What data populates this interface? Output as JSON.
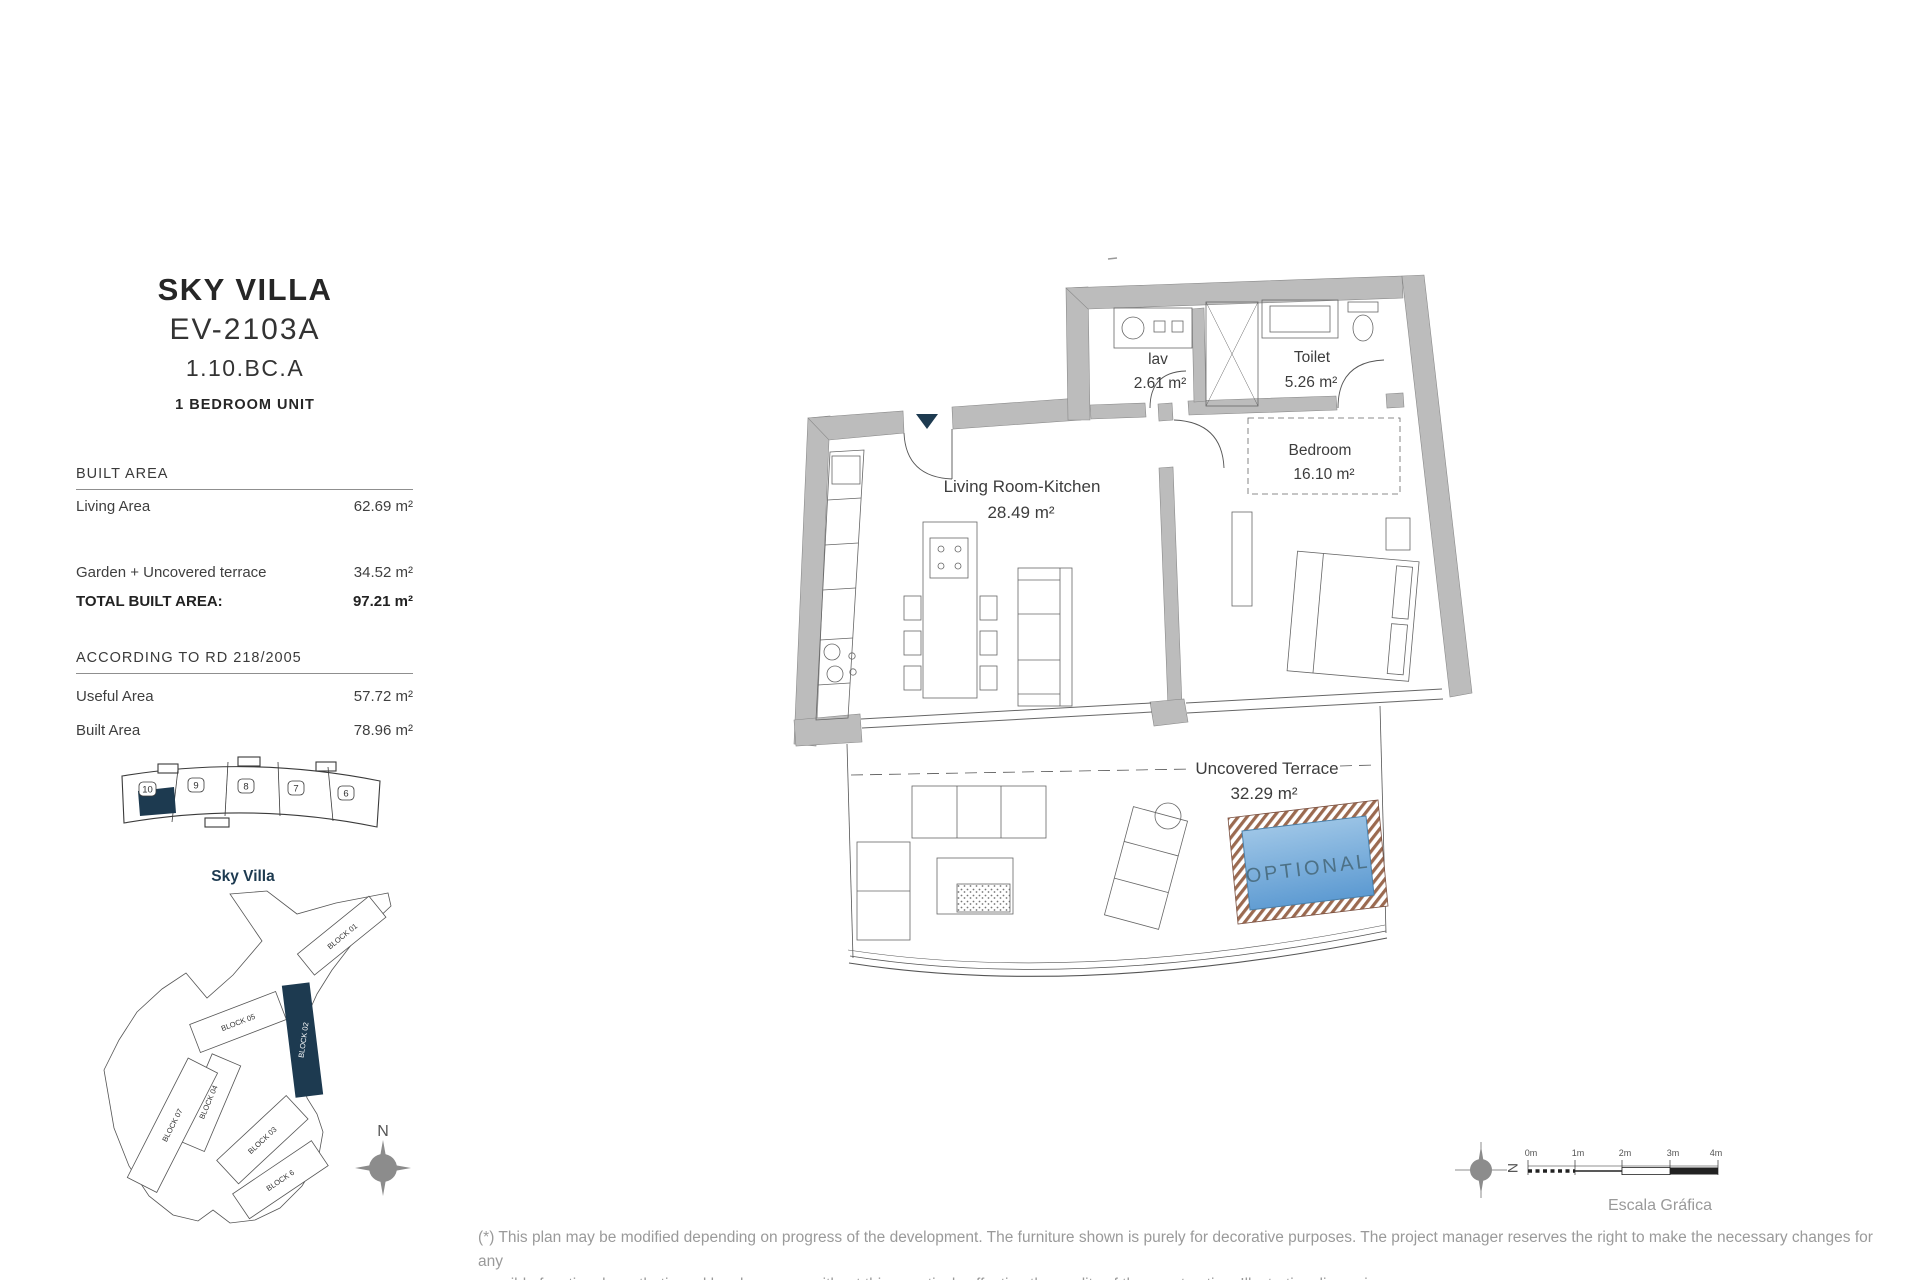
{
  "header": {
    "title": "SKY VILLA",
    "code": "EV-2103A",
    "ref": "1.10.BC.A",
    "unit_type": "1 BEDROOM UNIT"
  },
  "built_area": {
    "title": "BUILT AREA",
    "rows": [
      {
        "label": "Living Area",
        "value": "62.69 m²"
      },
      {
        "label": "Garden + Uncovered terrace",
        "value": "34.52 m²"
      },
      {
        "label": "TOTAL BUILT AREA:",
        "value": "97.21 m²"
      }
    ]
  },
  "rd_area": {
    "title": "ACCORDING TO RD 218/2005",
    "rows": [
      {
        "label": "Useful Area",
        "value": "57.72 m²"
      },
      {
        "label": "Built Area",
        "value": "78.96 m²"
      }
    ]
  },
  "floor_strip": {
    "units": [
      "10",
      "9",
      "8",
      "7",
      "6"
    ],
    "label": "Sky Villa"
  },
  "site_plan": {
    "blocks": [
      "BLOCK 01",
      "BLOCK 02",
      "BLOCK 05",
      "BLOCK 04",
      "BLOCK 07",
      "BLOCK 03",
      "BLOCK 6"
    ],
    "highlighted": "BLOCK 02",
    "north": "N"
  },
  "plan": {
    "rooms": [
      {
        "name": "lav",
        "area": "2.61 m²"
      },
      {
        "name": "Toilet",
        "area": "5.26 m²"
      },
      {
        "name": "Bedroom",
        "area": "16.10 m²"
      },
      {
        "name": "Living Room-Kitchen",
        "area": "28.49 m²"
      },
      {
        "name": "Uncovered Terrace",
        "area": "32.29 m²"
      }
    ],
    "pool_label": "OPTIONAL"
  },
  "scale": {
    "ticks": [
      "0m",
      "1m",
      "2m",
      "3m",
      "4m"
    ],
    "label": "Escala Gráfica",
    "north": "N"
  },
  "footer": {
    "line1": "(*) This plan may be modified depending on progress of the development. The furniture shown is purely for decorative purposes. The project manager reserves the right to make the necessary changes for any",
    "line2": "possible functional, aesthetic and legal reasons, without this negatively affecting the quality of the construction. Illustrative dimensions."
  },
  "colors": {
    "accent_dark": "#1d3a50",
    "wall_gray": "#bcbcbc",
    "pool_top": "#a9cdea",
    "pool_bottom": "#5e9bd2",
    "deck_brown": "#9b6a50",
    "muted_text": "#9a9a9a"
  }
}
